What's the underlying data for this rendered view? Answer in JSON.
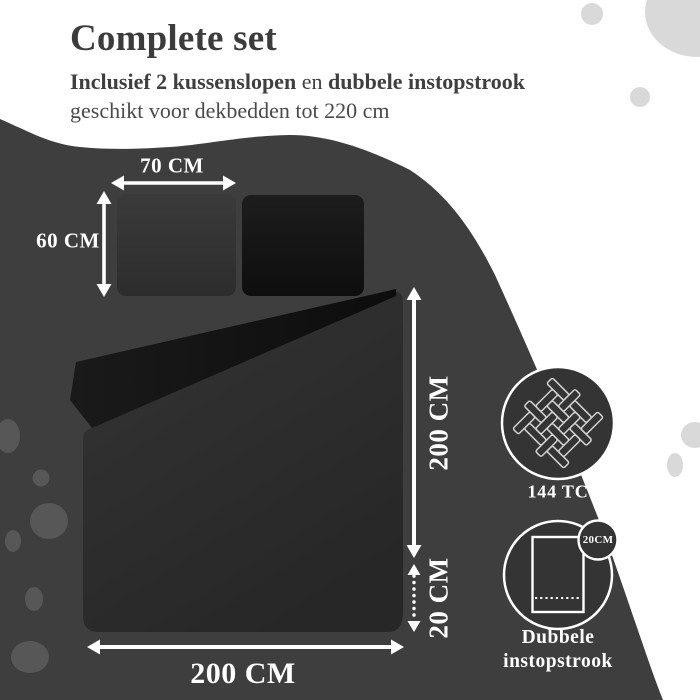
{
  "header": {
    "title": "Complete set",
    "subtitle_bold1": "Inclusief 2 kussenslopen",
    "subtitle_mid": " en ",
    "subtitle_bold2": "dubbele instopstrook",
    "subtitle_line2": "geschikt voor dekbedden tot 220 cm"
  },
  "dimensions": {
    "pillow_width": "70 CM",
    "pillow_height": "60 CM",
    "duvet_length": "200 CM",
    "tuck_length": "20 CM",
    "duvet_width": "200 CM"
  },
  "badges": {
    "thread_count": {
      "label": "144 TC",
      "icon": "fabric-weave-icon"
    },
    "tuck": {
      "line1": "Dubbele",
      "line2": "instopstrook",
      "tag": "20CM",
      "icon": "sheet-tuck-icon"
    }
  },
  "colors": {
    "background": "#FFFFFF",
    "blob": "#3E3E3E",
    "blob_dot": "#575757",
    "light_dot": "#D9D9D9",
    "heading_text": "#3C3C3C",
    "subtext": "#4A4A4A",
    "annotation_text": "#FFFFFF",
    "pillow_grey": "#343434",
    "pillow_black": "#141414",
    "duvet": "#2C2C2C",
    "duvet_fold": "#131313",
    "badge_fill": "#343434",
    "badge_ring": "#FFFFFF"
  }
}
